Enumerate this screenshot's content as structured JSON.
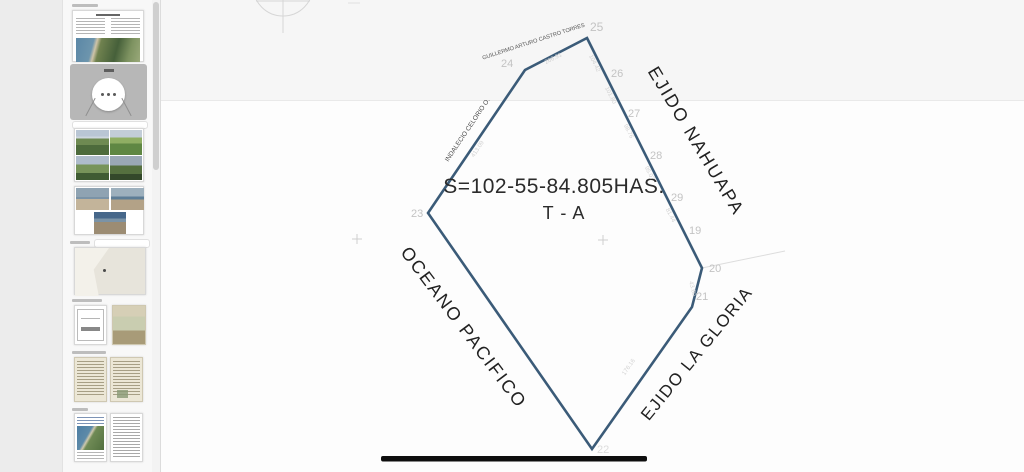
{
  "window": {
    "kind": "document-viewer-with-thumbnail-sidebar"
  },
  "sidebar": {
    "thumbnails": [
      {
        "name": "survey-cover-page"
      },
      {
        "name": "plan-page-placeholder-selected",
        "dots": "• • •"
      },
      {
        "name": "field-photos-grid"
      },
      {
        "name": "beach-photos"
      },
      {
        "name": "location-map"
      },
      {
        "name": "document-pair"
      },
      {
        "name": "scanned-letters"
      },
      {
        "name": "report-pages"
      }
    ]
  },
  "survey": {
    "area_label": "S=102-55-84.805HAS.",
    "lot_label": "T - A",
    "region_north": "EJIDO NAHUAPA",
    "region_southeast": "EJIDO LA GLORIA",
    "region_west": "OCEANO PACIFICO",
    "owner_top": "GUILLERMO ARTURO CASTRO TORRES",
    "owner_left": "INDALECIO CELORIO O.",
    "vertices": [
      "23",
      "24",
      "25",
      "26",
      "27",
      "28",
      "29",
      "19",
      "20",
      "21",
      "22"
    ],
    "edge_lengths": [
      "266.91",
      "413.09",
      "104.42",
      "101.80",
      "98.76",
      "95.07",
      "81.44",
      "43.60",
      "176.16"
    ],
    "line_color": "#3b5b78"
  }
}
